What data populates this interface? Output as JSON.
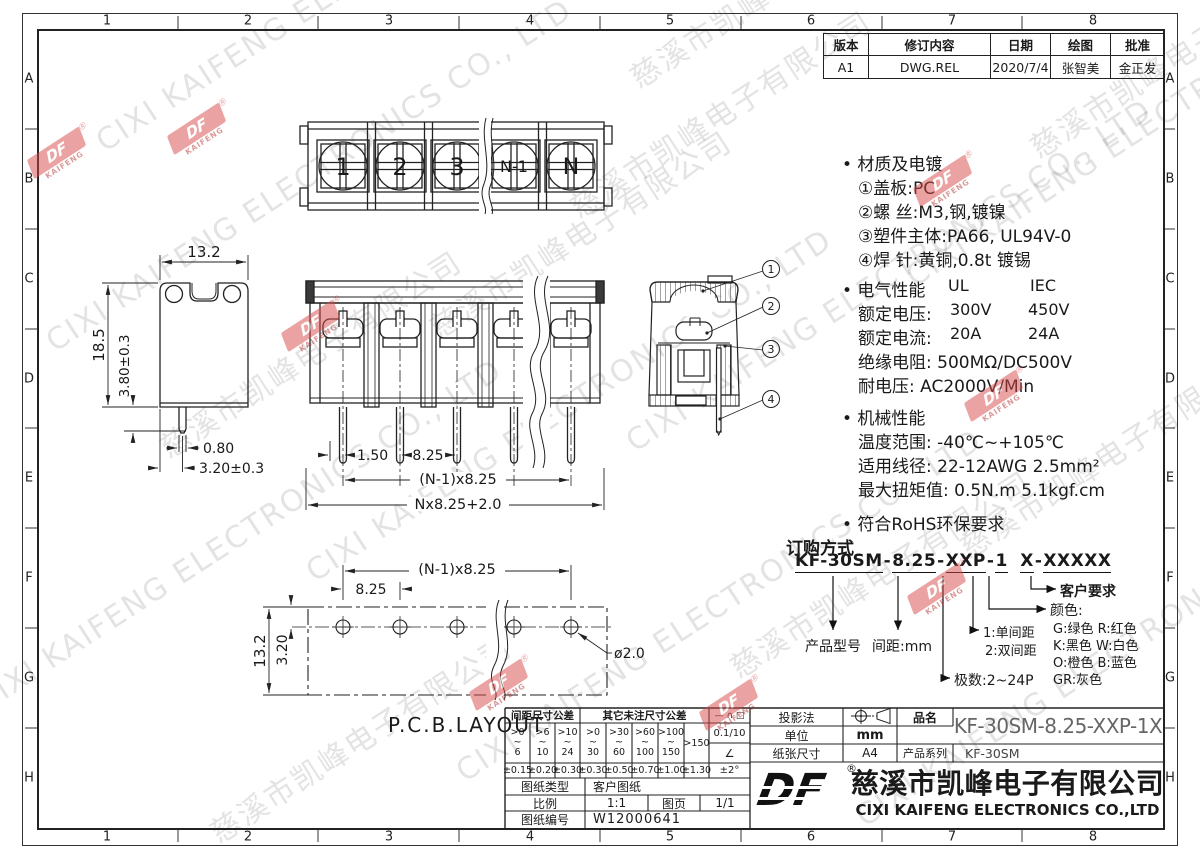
{
  "frame": {
    "letters": [
      "A",
      "B",
      "C",
      "D",
      "E",
      "F",
      "G",
      "H"
    ],
    "numbers": [
      "1",
      "2",
      "3",
      "4",
      "5",
      "6",
      "7",
      "8"
    ]
  },
  "revision": {
    "headers": [
      "版本",
      "修订内容",
      "日期",
      "绘图",
      "批准"
    ],
    "row": [
      "A1",
      "DWG.REL",
      "2020/7/4",
      "张智美",
      "金正发"
    ]
  },
  "notes": {
    "material_title": "• 材质及电镀",
    "material_items": [
      "①盖板:PC",
      "②螺 丝:M3,钢,镀镍",
      "③塑件主体:PA66, UL94V-0",
      "④焊 针:黄铜,0.8t 镀锡"
    ],
    "electrical_title": "• 电气性能",
    "col_ul": "UL",
    "col_iec": "IEC",
    "row_voltage_label": "额定电压:",
    "row_voltage_ul": "300V",
    "row_voltage_iec": "450V",
    "row_current_label": "额定电流:",
    "row_current_ul": "20A",
    "row_current_iec": "24A",
    "line_insulation": "绝缘电阻: 500MΩ/DC500V",
    "line_withstand": "耐电压: AC2000V/Min",
    "mechanical_title": "• 机械性能",
    "mechanical_items": [
      "温度范围: -40℃~+105℃",
      "适用线径: 22-12AWG 2.5mm²",
      "最大扭矩值: 0.5N.m 5.1kgf.cm"
    ],
    "rohs": "• 符合RoHS环保要求"
  },
  "ordering": {
    "title": "订购方式",
    "code_segments": [
      "KF-30SM",
      "8.25",
      "XXP",
      "1",
      "X",
      "XXXXX"
    ],
    "model_label": "产品型号",
    "pitch_label": "间距:mm",
    "poles_label": "极数:2~24P",
    "single_label": "1:单间距",
    "double_label": "2:双间距",
    "color_title": "颜色:",
    "color_rows": [
      "G:绿色  R:红色",
      "K:黑色  W:白色",
      "O:橙色  B:蓝色",
      "GR:灰色"
    ],
    "customer_label": "客户要求"
  },
  "top_view_labels": [
    "1",
    "2",
    "3",
    "N-1",
    "N"
  ],
  "callouts": [
    "1",
    "2",
    "3",
    "4"
  ],
  "dims": {
    "side_w": "13.2",
    "side_h": "18.5",
    "side_pin": "3.80±0.3",
    "side_pin_w": "0.80",
    "side_off": "3.20±0.3",
    "front_p1": "1.50",
    "front_p2": "8.25",
    "front_span": "(N-1)x8.25",
    "front_total": "Nx8.25+2.0",
    "pcb_span": "(N-1)x8.25",
    "pcb_pitch": "8.25",
    "pcb_h": "13.2",
    "pcb_off": "3.20",
    "pcb_hole": "ø2.0",
    "pcb_label": "P.C.B.LAYOUT"
  },
  "title_block": {
    "pitch_tol_title": "间距尺寸公差",
    "other_tol_title": "其它未注尺寸公差",
    "geo_symbols": "— ∩ □",
    "range_sep": "~",
    "ranges": [
      {
        "a": ">0",
        "b": "6"
      },
      {
        "a": ">6",
        "b": "10"
      },
      {
        "a": ">10",
        "b": "24"
      },
      {
        "a": ">0",
        "b": "30"
      },
      {
        "a": ">30",
        "b": "60"
      },
      {
        "a": ">60",
        "b": "100"
      },
      {
        "a": ">100",
        "b": "150"
      }
    ],
    "last_range": ">150",
    "tols": [
      "±0.15",
      "±0.20",
      "±0.30",
      "±0.30",
      "±0.50",
      "±0.70",
      "±1.00",
      "±1.30"
    ],
    "flatness": "0.1/10",
    "angle_symbol": "∠",
    "angle_tol": "±2°",
    "projection_label": "投影法",
    "unit_label": "单位",
    "unit_value": "mm",
    "paper_label": "纸张尺寸",
    "paper_value": "A4",
    "name_label": "品名",
    "part_number": "KF-30SM-8.25-XXP-1X",
    "series_label": "产品系列",
    "series_value": "KF-30SM",
    "type_label": "图纸类型",
    "type_value": "客户图纸",
    "scale_label": "比例",
    "scale_value": "1:1",
    "sheet_label": "图页",
    "sheet_value": "1/1",
    "dwgno_label": "图纸编号",
    "dwgno_value": "W12000641",
    "logo_text": "DF",
    "reg": "®",
    "company_cn": "慈溪市凯峰电子有限公司",
    "company_en": "CIXI KAIFENG ELECTRONICS CO.,LTD"
  },
  "watermark": {
    "cn": "慈溪市凯峰电子有限公司",
    "en": "CIXI KAIFENG ELECTRONICS CO., LTD",
    "logo_text": "DF",
    "logo_sub": "KAIFENG",
    "reg": "®"
  }
}
